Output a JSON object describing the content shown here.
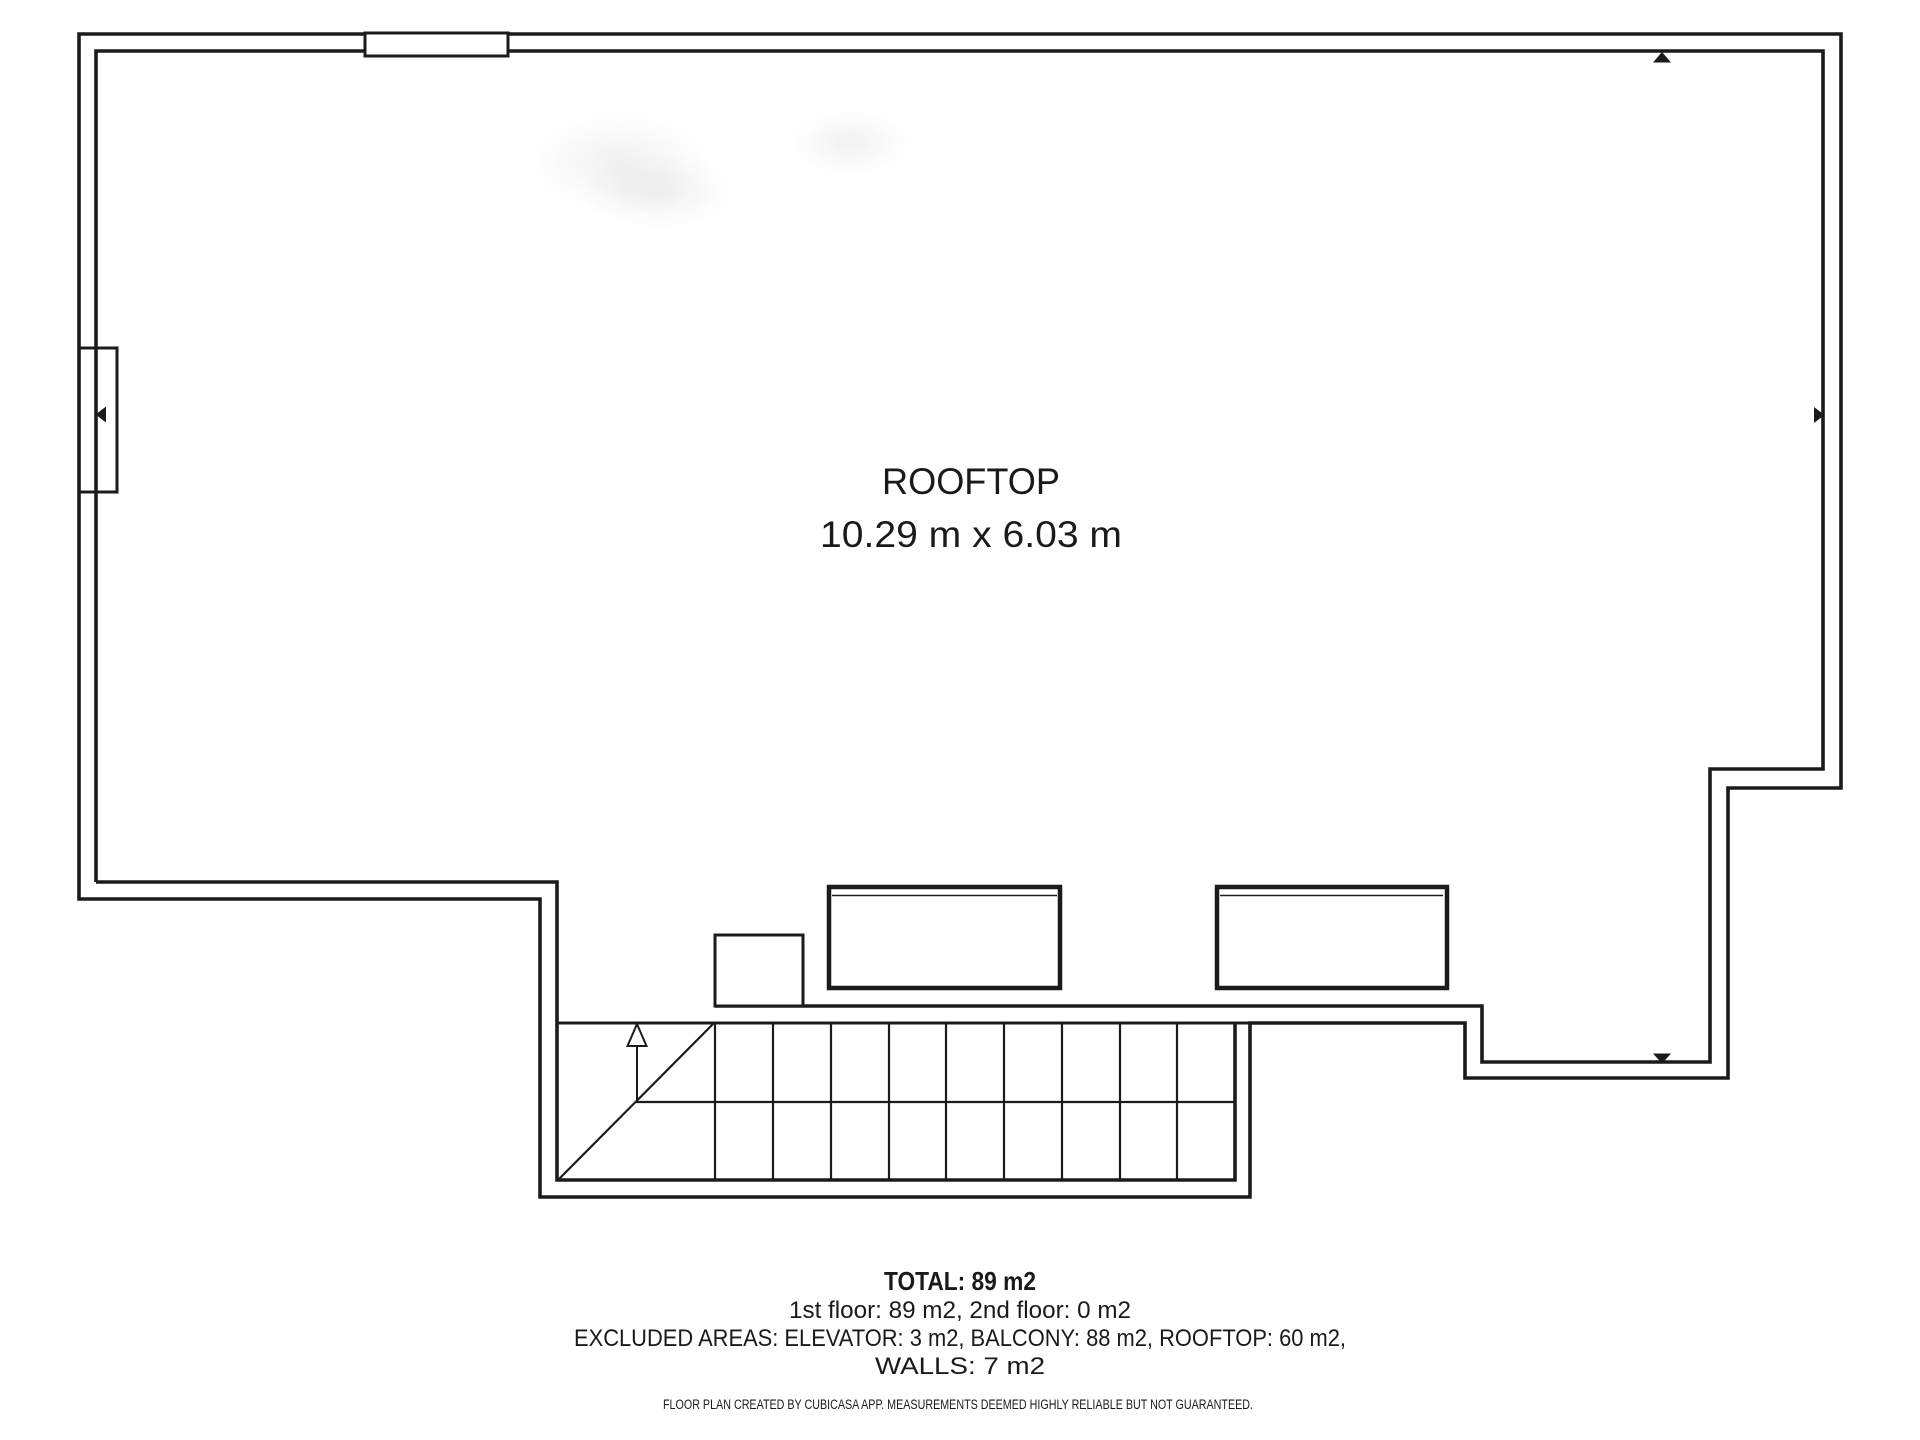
{
  "colors": {
    "line": "#1b1b1b",
    "text": "#1a1a1a"
  },
  "room": {
    "label": "ROOFTOP",
    "dimensions": "10.29 m x 6.03 m"
  },
  "summary": {
    "total": "TOTAL: 89 m2",
    "floors": "1st floor: 89 m2, 2nd floor: 0 m2",
    "excluded_line1": "EXCLUDED AREAS: ELEVATOR: 3 m2, BALCONY: 88 m2, ROOFTOP: 60 m2,",
    "excluded_line2": "WALLS: 7 m2"
  },
  "disclaimer": "FLOOR PLAN CREATED BY CUBICASA APP. MEASUREMENTS DEEMED HIGHLY RELIABLE BUT NOT GUARANTEED."
}
